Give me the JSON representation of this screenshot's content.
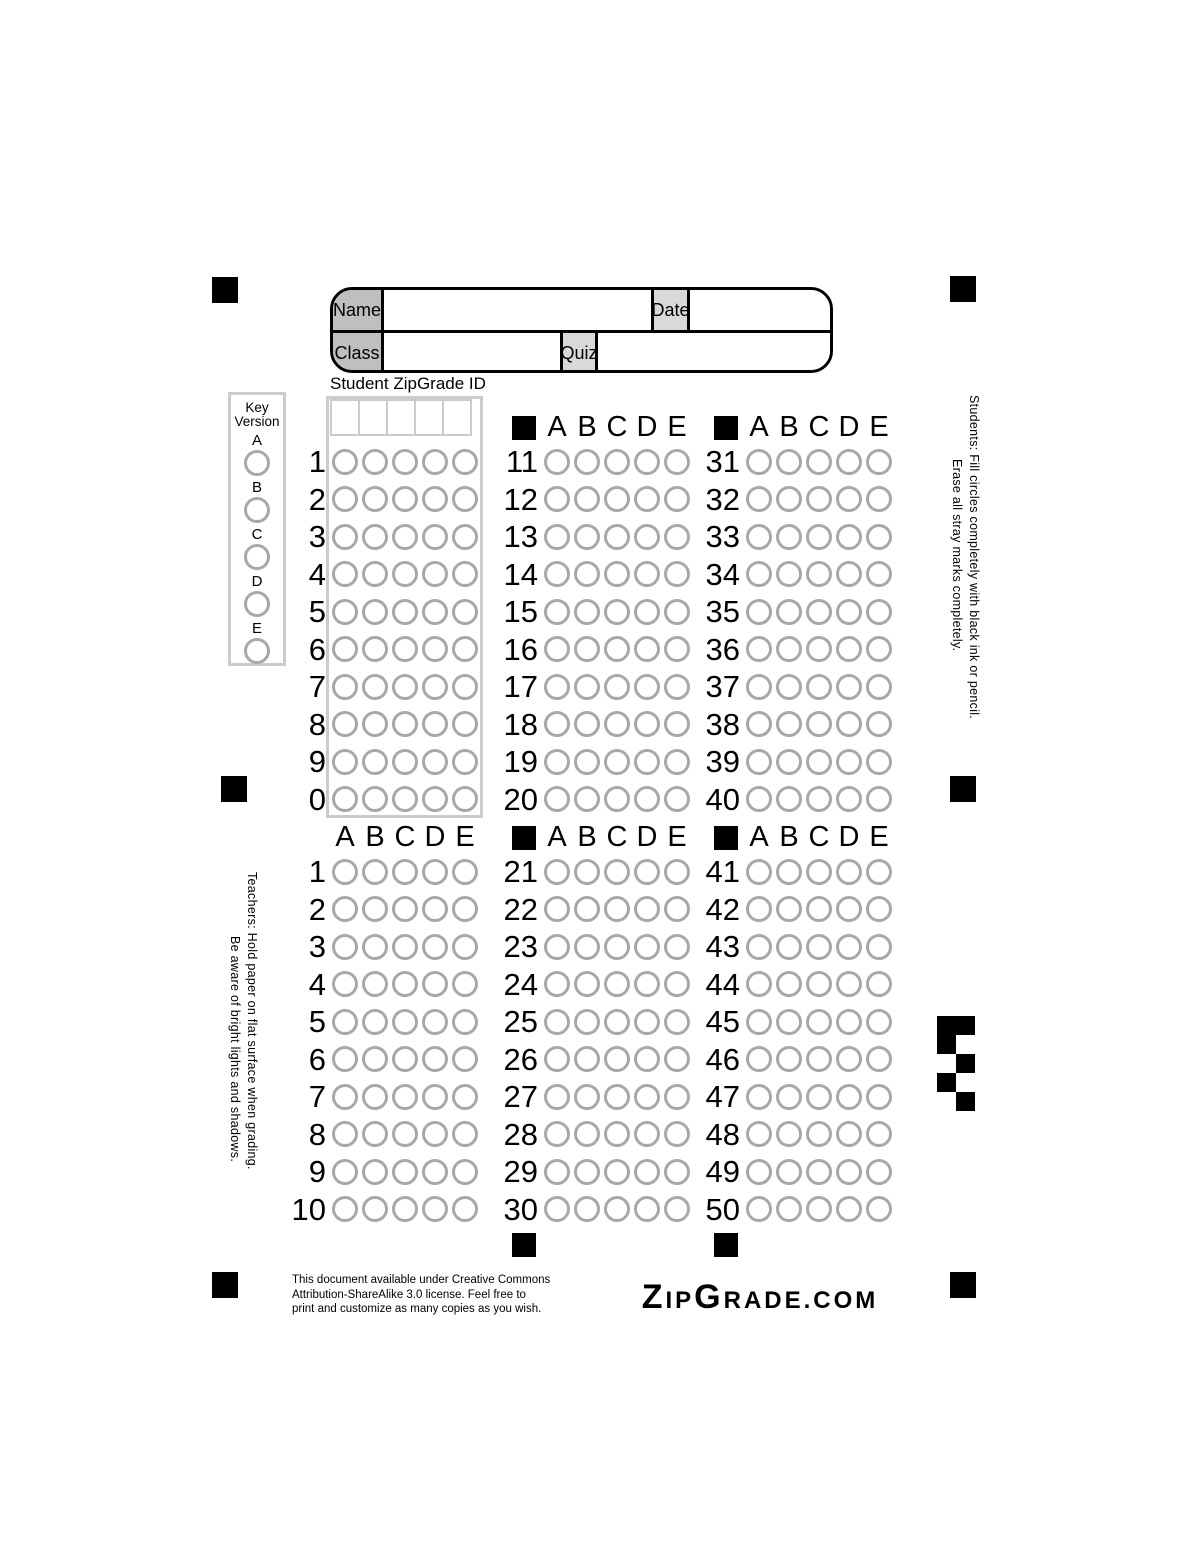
{
  "form": {
    "name_label": "Name",
    "date_label": "Date",
    "class_label": "Class",
    "quiz_label": "Quiz"
  },
  "student_id": {
    "label": "Student ZipGrade ID",
    "columns": 5,
    "row_digits": [
      "1",
      "2",
      "3",
      "4",
      "5",
      "6",
      "7",
      "8",
      "9",
      "0"
    ]
  },
  "key_version": {
    "title_line1": "Key",
    "title_line2": "Version",
    "options": [
      "A",
      "B",
      "C",
      "D",
      "E"
    ]
  },
  "answer_choices": [
    "A",
    "B",
    "C",
    "D",
    "E"
  ],
  "question_groups": [
    {
      "numbers": [
        "11",
        "12",
        "13",
        "14",
        "15",
        "16",
        "17",
        "18",
        "19",
        "20"
      ],
      "header_square": true,
      "bottom_square": false
    },
    {
      "numbers": [
        "31",
        "32",
        "33",
        "34",
        "35",
        "36",
        "37",
        "38",
        "39",
        "40"
      ],
      "header_square": true,
      "bottom_square": false
    },
    {
      "numbers": [
        "1",
        "2",
        "3",
        "4",
        "5",
        "6",
        "7",
        "8",
        "9",
        "10"
      ],
      "header_square": false,
      "bottom_square": false
    },
    {
      "numbers": [
        "21",
        "22",
        "23",
        "24",
        "25",
        "26",
        "27",
        "28",
        "29",
        "30"
      ],
      "header_square": true,
      "bottom_square": true
    },
    {
      "numbers": [
        "41",
        "42",
        "43",
        "44",
        "45",
        "46",
        "47",
        "48",
        "49",
        "50"
      ],
      "header_square": true,
      "bottom_square": true
    }
  ],
  "instructions": {
    "students_line1": "Students:  Fill circles completely with black ink or pencil.",
    "students_line2": "Erase all stray marks completely.",
    "teachers_line1": "Teachers: Hold paper on flat surface when grading.",
    "teachers_line2": "Be aware of bright lights and shadows."
  },
  "footer": {
    "license_line1": "This document available under Creative Commons",
    "license_line2": "Attribution-ShareAlike 3.0 license.  Feel free to",
    "license_line3": "print and customize as many copies as you wish.",
    "logo_parts": [
      {
        "text": "Z",
        "size": "large"
      },
      {
        "text": "IP",
        "size": "small"
      },
      {
        "text": "G",
        "size": "large"
      },
      {
        "text": "RADE",
        "size": "small"
      },
      {
        "text": ".COM",
        "size": "small"
      }
    ]
  },
  "colors": {
    "registration_black": "#000000",
    "bubble_outline": "#a8a8a8",
    "label_fill_dark": "#bfbfbf",
    "label_fill_light": "#d9d9d9",
    "box_outline": "#cccccc"
  }
}
